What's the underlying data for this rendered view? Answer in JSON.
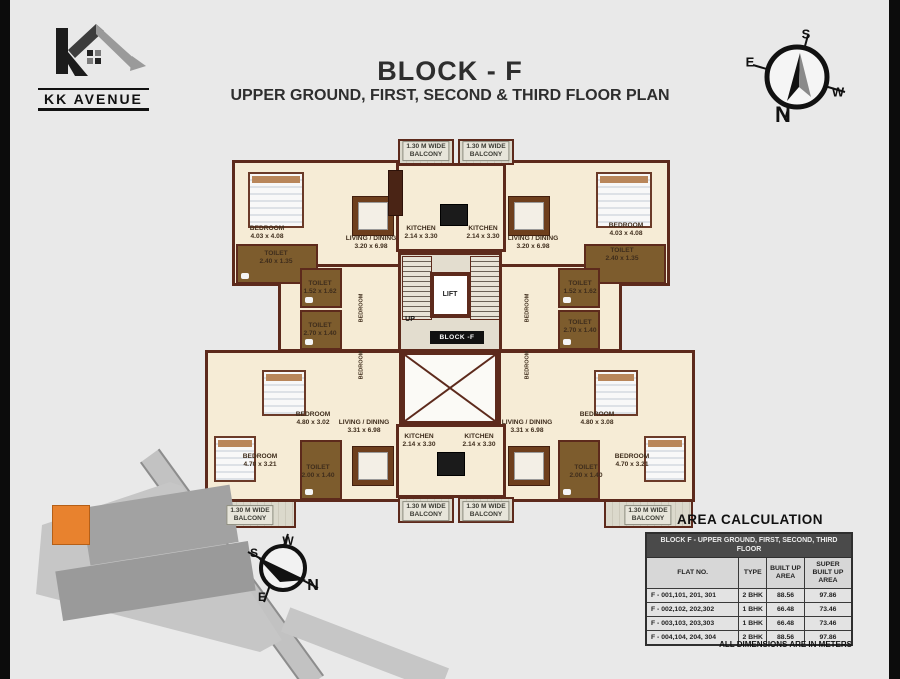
{
  "logo": {
    "name": "KK AVENUE"
  },
  "title": {
    "block": "BLOCK -  F",
    "subtitle": "UPPER GROUND, FIRST, SECOND & THIRD FLOOR PLAN"
  },
  "compass_top": {
    "n": "N",
    "s": "S",
    "e": "E",
    "w": "W"
  },
  "compass_site": {
    "n": "N",
    "s": "S",
    "e": "E",
    "w": "W"
  },
  "plan": {
    "core": {
      "block_tag": "BLOCK -F"
    },
    "labels": [
      {
        "t": [
          "1.30 M WIDE",
          "BALCONY"
        ],
        "x": 426,
        "y": 151,
        "cls": "tag",
        "name": "balcony-label"
      },
      {
        "t": [
          "1.30 M WIDE",
          "BALCONY"
        ],
        "x": 486,
        "y": 151,
        "cls": "tag",
        "name": "balcony-label"
      },
      {
        "t": [
          "BEDROOM",
          "4.03 x 4.08"
        ],
        "x": 267,
        "y": 233,
        "name": "bedroom-label"
      },
      {
        "t": [
          "TOILET",
          "2.40 x 1.35"
        ],
        "x": 276,
        "y": 258,
        "name": "toilet-label"
      },
      {
        "t": [
          "LIVING / DINING",
          "3.20 x 6.98"
        ],
        "x": 371,
        "y": 243,
        "name": "living-dining-label"
      },
      {
        "t": [
          "KITCHEN",
          "2.14 x 3.30"
        ],
        "x": 421,
        "y": 233,
        "name": "kitchen-label"
      },
      {
        "t": [
          "KITCHEN",
          "2.14 x 3.30"
        ],
        "x": 483,
        "y": 233,
        "name": "kitchen-label"
      },
      {
        "t": [
          "LIVING / DINING",
          "3.20 x 6.98"
        ],
        "x": 533,
        "y": 243,
        "name": "living-dining-label"
      },
      {
        "t": [
          "BEDROOM",
          "4.03 x 4.08"
        ],
        "x": 626,
        "y": 230,
        "name": "bedroom-label"
      },
      {
        "t": [
          "TOILET",
          "2.40 x 1.35"
        ],
        "x": 622,
        "y": 255,
        "name": "toilet-label"
      },
      {
        "t": [
          "TOILET",
          "1.52 x 1.62"
        ],
        "x": 320,
        "y": 288,
        "name": "toilet-label"
      },
      {
        "t": [
          "TOILET",
          "2.70 x 1.40"
        ],
        "x": 320,
        "y": 330,
        "name": "toilet-label"
      },
      {
        "t": [
          "TOILET",
          "1.52 x 1.62"
        ],
        "x": 580,
        "y": 288,
        "name": "toilet-label"
      },
      {
        "t": [
          "TOILET",
          "2.70 x 1.40"
        ],
        "x": 580,
        "y": 327,
        "name": "toilet-label"
      },
      {
        "t": [
          "BEDROOM"
        ],
        "x": 362,
        "y": 308,
        "r": 1,
        "name": "bedroom-label-vertical"
      },
      {
        "t": [
          "BEDROOM"
        ],
        "x": 362,
        "y": 365,
        "r": 1,
        "name": "bedroom-label-vertical"
      },
      {
        "t": [
          "BEDROOM"
        ],
        "x": 528,
        "y": 308,
        "r": 1,
        "name": "bedroom-label-vertical"
      },
      {
        "t": [
          "BEDROOM"
        ],
        "x": 528,
        "y": 365,
        "r": 1,
        "name": "bedroom-label-vertical"
      },
      {
        "t": [
          "LIFT"
        ],
        "x": 450,
        "y": 295,
        "cls": "lift",
        "name": "lift-label"
      },
      {
        "t": [
          "UP"
        ],
        "x": 410,
        "y": 320,
        "cls": "up",
        "name": "up-label"
      },
      {
        "t": [
          "BEDROOM",
          "4.80 x 3.02"
        ],
        "x": 313,
        "y": 419,
        "name": "bedroom-label"
      },
      {
        "t": [
          "BEDROOM",
          "4.80 x 3.08"
        ],
        "x": 597,
        "y": 419,
        "name": "bedroom-label"
      },
      {
        "t": [
          "LIVING / DINING",
          "3.31 x 6.98"
        ],
        "x": 364,
        "y": 427,
        "name": "living-dining-label"
      },
      {
        "t": [
          "LIVING / DINING",
          "3.31 x 6.98"
        ],
        "x": 527,
        "y": 427,
        "name": "living-dining-label"
      },
      {
        "t": [
          "KITCHEN",
          "2.14 x 3.30"
        ],
        "x": 419,
        "y": 441,
        "name": "kitchen-label"
      },
      {
        "t": [
          "KITCHEN",
          "2.14 x 3.30"
        ],
        "x": 479,
        "y": 441,
        "name": "kitchen-label"
      },
      {
        "t": [
          "BEDROOM",
          "4.70 x 3.21"
        ],
        "x": 260,
        "y": 461,
        "name": "bedroom-label"
      },
      {
        "t": [
          "BEDROOM",
          "4.70 x 3.21"
        ],
        "x": 632,
        "y": 461,
        "name": "bedroom-label"
      },
      {
        "t": [
          "TOILET",
          "2.00 x 1.40"
        ],
        "x": 318,
        "y": 472,
        "name": "toilet-label"
      },
      {
        "t": [
          "TOILET",
          "2.00 x 1.40"
        ],
        "x": 586,
        "y": 472,
        "name": "toilet-label"
      },
      {
        "t": [
          "1.30 M WIDE",
          "BALCONY"
        ],
        "x": 250,
        "y": 515,
        "cls": "tag",
        "name": "balcony-label"
      },
      {
        "t": [
          "1.30 M WIDE",
          "BALCONY"
        ],
        "x": 426,
        "y": 511,
        "cls": "tag",
        "name": "balcony-label"
      },
      {
        "t": [
          "1.30 M WIDE",
          "BALCONY"
        ],
        "x": 486,
        "y": 511,
        "cls": "tag",
        "name": "balcony-label"
      },
      {
        "t": [
          "1.30 M WIDE",
          "BALCONY"
        ],
        "x": 648,
        "y": 515,
        "cls": "tag",
        "name": "balcony-label"
      }
    ]
  },
  "area_table": {
    "title": "AREA CALCULATION",
    "header": "BLOCK F - UPPER GROUND, FIRST, SECOND, THIRD FLOOR",
    "columns": [
      "FLAT NO.",
      "TYPE",
      "BUILT UP AREA",
      "SUPER BUILT UP AREA"
    ],
    "rows": [
      [
        "F - 001,101, 201, 301",
        "2 BHK",
        "88.56",
        "97.86"
      ],
      [
        "F - 002,102, 202,302",
        "1 BHK",
        "66.48",
        "73.46"
      ],
      [
        "F - 003,103, 203,303",
        "1 BHK",
        "66.48",
        "73.46"
      ],
      [
        "F - 004,104, 204, 304",
        "2 BHK",
        "88.56",
        "97.86"
      ]
    ],
    "footnote": "ALL DIMENSIONS ARE IN METERS"
  },
  "colors": {
    "background": "#e9e9e9",
    "wall": "#5d2a1c",
    "room_fill": "#f6ecd6",
    "wet_area_fill": "#7d5c2d",
    "table_band": "#4a4a4a",
    "site_highlight_orange": "#e8822e"
  }
}
